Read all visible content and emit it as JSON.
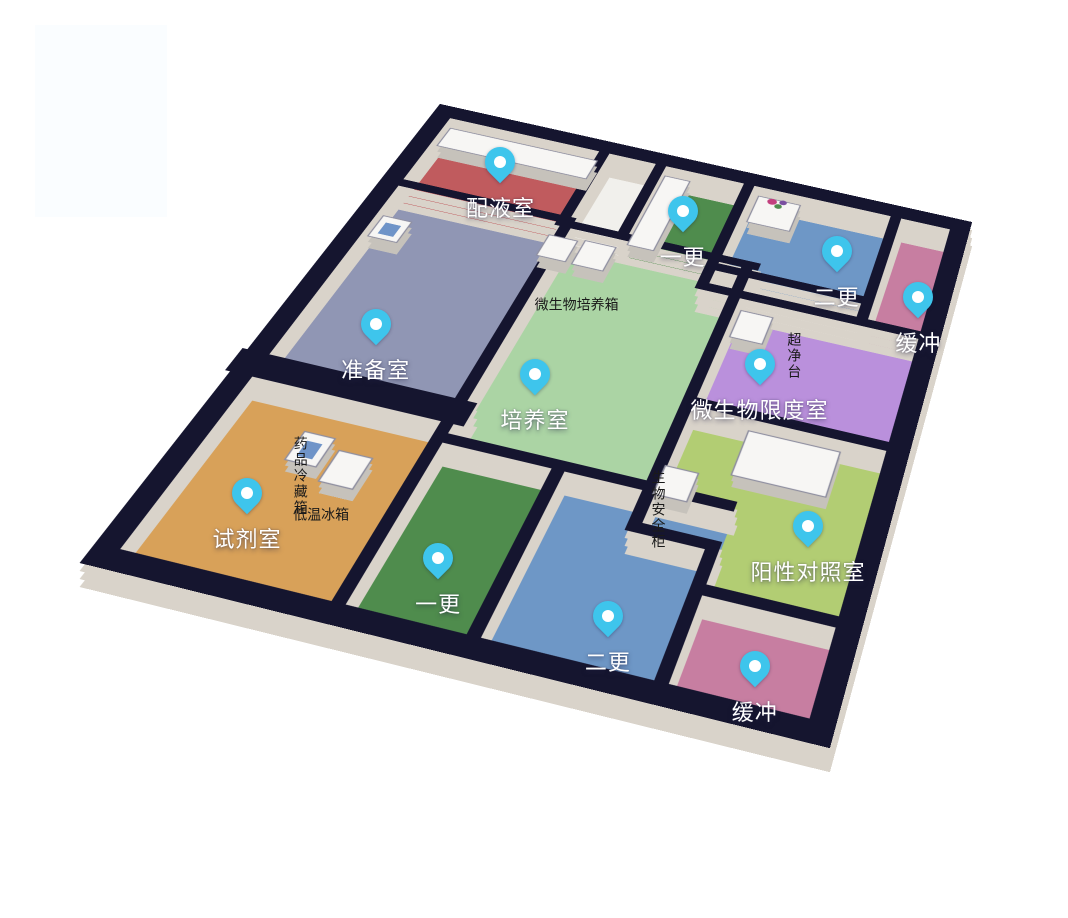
{
  "page": {
    "background": "#ffffff"
  },
  "palette": {
    "wall_top": "#15152F",
    "wall_face": "#D9D3CA",
    "corridor_floor": "#F1F0EC",
    "pin_fill": "#3EC5EC",
    "pin_hole": "#FFFFFF",
    "equipment_top": "#F7F6F4",
    "equipment_side": "#C6C2BB",
    "equipment_outline": "#8F8FA0",
    "accent_blue": "#6F94C8",
    "room_label_color": "#FFFFFF",
    "equipment_label_color": "#1A1A1A",
    "flower_pink": "#C2407E",
    "flower_green": "#4E8C4E",
    "flower_purple": "#7A4FA0"
  },
  "decor": {
    "watermark": {
      "x": 35,
      "y": 25,
      "w": 132,
      "h": 192,
      "color": "#FAFDFF"
    }
  },
  "floorplan": {
    "plan_width": 500,
    "plan_height": 560,
    "rooms": [
      {
        "id": "peiyeshi",
        "label": "配液室",
        "color": "#C05B5E",
        "poly": [
          [
            0,
            0
          ],
          [
            160,
            0
          ],
          [
            160,
            115
          ],
          [
            0,
            115
          ]
        ],
        "pin": [
          76,
          52
        ]
      },
      {
        "id": "yigeng-top",
        "label": "一更",
        "color": "#4F8C4D",
        "poly": [
          [
            215,
            0
          ],
          [
            300,
            0
          ],
          [
            300,
            120
          ],
          [
            215,
            120
          ]
        ],
        "pin": [
          253,
          64
        ]
      },
      {
        "id": "ergeng-top",
        "label": "二更",
        "color": "#6E97C6",
        "poly": [
          [
            300,
            0
          ],
          [
            440,
            0
          ],
          [
            440,
            132
          ],
          [
            300,
            132
          ]
        ],
        "pin": [
          398,
          71
        ]
      },
      {
        "id": "huanchong-top",
        "label": "缓冲",
        "color": "#C77EA1",
        "poly": [
          [
            440,
            0
          ],
          [
            500,
            0
          ],
          [
            500,
            160
          ],
          [
            440,
            160
          ]
        ],
        "pin": [
          480,
          108
        ]
      },
      {
        "id": "zhunbeishi",
        "label": "准备室",
        "color": "#9096B4",
        "poly": [
          [
            0,
            115
          ],
          [
            165,
            115
          ],
          [
            165,
            360
          ],
          [
            0,
            360
          ]
        ],
        "pin": [
          67,
          288
        ]
      },
      {
        "id": "peiyangshi",
        "label": "培养室",
        "color": "#ABD4A4",
        "poly": [
          [
            165,
            120
          ],
          [
            330,
            120
          ],
          [
            330,
            390
          ],
          [
            165,
            390
          ]
        ],
        "pin": [
          206,
          302
        ]
      },
      {
        "id": "weishengwu-xiandushi",
        "label": "微生物限度室",
        "color": "#BA90DC",
        "poly": [
          [
            330,
            160
          ],
          [
            500,
            160
          ],
          [
            500,
            295
          ],
          [
            330,
            295
          ]
        ],
        "pin": [
          371,
          234
        ]
      },
      {
        "id": "yangxing-duizhaoshi",
        "label": "阳性对照室",
        "color": "#B2CD73",
        "poly": [
          [
            330,
            295
          ],
          [
            500,
            295
          ],
          [
            500,
            470
          ],
          [
            390,
            470
          ],
          [
            390,
            430
          ],
          [
            330,
            430
          ]
        ],
        "pin": [
          450,
          389
        ]
      },
      {
        "id": "shijishi",
        "label": "试剂室",
        "color": "#D8A159",
        "poly": [
          [
            0,
            360
          ],
          [
            165,
            360
          ],
          [
            165,
            560
          ],
          [
            0,
            560
          ]
        ],
        "pin": [
          61,
          479
        ]
      },
      {
        "id": "yigeng-bottom",
        "label": "一更",
        "color": "#4F8C4D",
        "poly": [
          [
            165,
            390
          ],
          [
            260,
            390
          ],
          [
            260,
            560
          ],
          [
            165,
            560
          ]
        ],
        "pin": [
          210,
          494
        ]
      },
      {
        "id": "ergeng-bottom",
        "label": "二更",
        "color": "#6E97C6",
        "poly": [
          [
            260,
            390
          ],
          [
            390,
            390
          ],
          [
            390,
            560
          ],
          [
            260,
            560
          ]
        ],
        "pin": [
          338,
          508
        ]
      },
      {
        "id": "huanchong-bottom",
        "label": "缓冲",
        "color": "#C77EA1",
        "poly": [
          [
            390,
            470
          ],
          [
            500,
            470
          ],
          [
            500,
            560
          ],
          [
            390,
            560
          ]
        ],
        "pin": [
          445,
          519
        ]
      }
    ],
    "equipment": [
      {
        "id": "cabinet-row",
        "rect": [
          8,
          6,
          144,
          30
        ]
      },
      {
        "id": "locker-row",
        "rect": [
          218,
          6,
          24,
          108
        ]
      },
      {
        "id": "shelf-flowers",
        "rect": [
          308,
          5,
          40,
          41
        ],
        "decor": "flowers"
      },
      {
        "id": "prep-device",
        "rect": [
          8,
          148,
          26,
          30
        ],
        "accent": true
      },
      {
        "id": "incubator-1",
        "rect": [
          150,
          124,
          26,
          30
        ]
      },
      {
        "id": "incubator-2",
        "rect": [
          182,
          121,
          28,
          34
        ],
        "label": "微生物培养箱",
        "label_pos": [
          200,
          192
        ],
        "orientation": "h"
      },
      {
        "id": "clean-bench",
        "rect": [
          336,
          165,
          28,
          35
        ],
        "label": "超净台",
        "label_pos": [
          380,
          162
        ],
        "orientation": "v"
      },
      {
        "id": "medicine-fridge",
        "rect": [
          66,
          404,
          24,
          30
        ],
        "accent": true,
        "label": "药品冷藏箱",
        "label_pos": [
          58,
          398
        ],
        "orientation": "v"
      },
      {
        "id": "low-temp-freezer",
        "rect": [
          98,
          414,
          26,
          32
        ],
        "label": "低温冰箱",
        "label_pos": [
          110,
          466
        ],
        "orientation": "h"
      },
      {
        "id": "shelf-unit",
        "rect": [
          380,
          300,
          74,
          49
        ]
      },
      {
        "id": "biosafety-cabinet",
        "rect": [
          330,
          355,
          26,
          30
        ],
        "label": "生物安全柜",
        "label_pos": [
          321,
          350
        ],
        "orientation": "v"
      }
    ],
    "walls_interior": [
      {
        "seg": [
          0,
          115,
          165,
          115
        ]
      },
      {
        "seg": [
          160,
          120,
          335,
          120
        ]
      },
      {
        "seg": [
          300,
          132,
          440,
          132
        ]
      },
      {
        "seg": [
          300,
          160,
          500,
          160
        ]
      },
      {
        "seg": [
          330,
          295,
          500,
          295
        ]
      },
      {
        "seg": [
          0,
          362,
          165,
          362
        ],
        "w": 26
      },
      {
        "seg": [
          165,
          390,
          390,
          390
        ]
      },
      {
        "seg": [
          330,
          430,
          390,
          430
        ]
      },
      {
        "seg": [
          390,
          470,
          500,
          470
        ]
      },
      {
        "seg": [
          160,
          0,
          160,
          120
        ]
      },
      {
        "seg": [
          215,
          0,
          215,
          120
        ]
      },
      {
        "seg": [
          300,
          0,
          300,
          160
        ]
      },
      {
        "seg": [
          440,
          0,
          440,
          160
        ]
      },
      {
        "seg": [
          165,
          115,
          165,
          560
        ]
      },
      {
        "seg": [
          330,
          120,
          330,
          430
        ]
      },
      {
        "seg": [
          260,
          390,
          260,
          560
        ]
      },
      {
        "seg": [
          390,
          430,
          390,
          560
        ]
      }
    ],
    "wall_outer": {
      "x": 0,
      "y": 0,
      "w": 500,
      "h": 560,
      "stroke_width": 18
    }
  }
}
